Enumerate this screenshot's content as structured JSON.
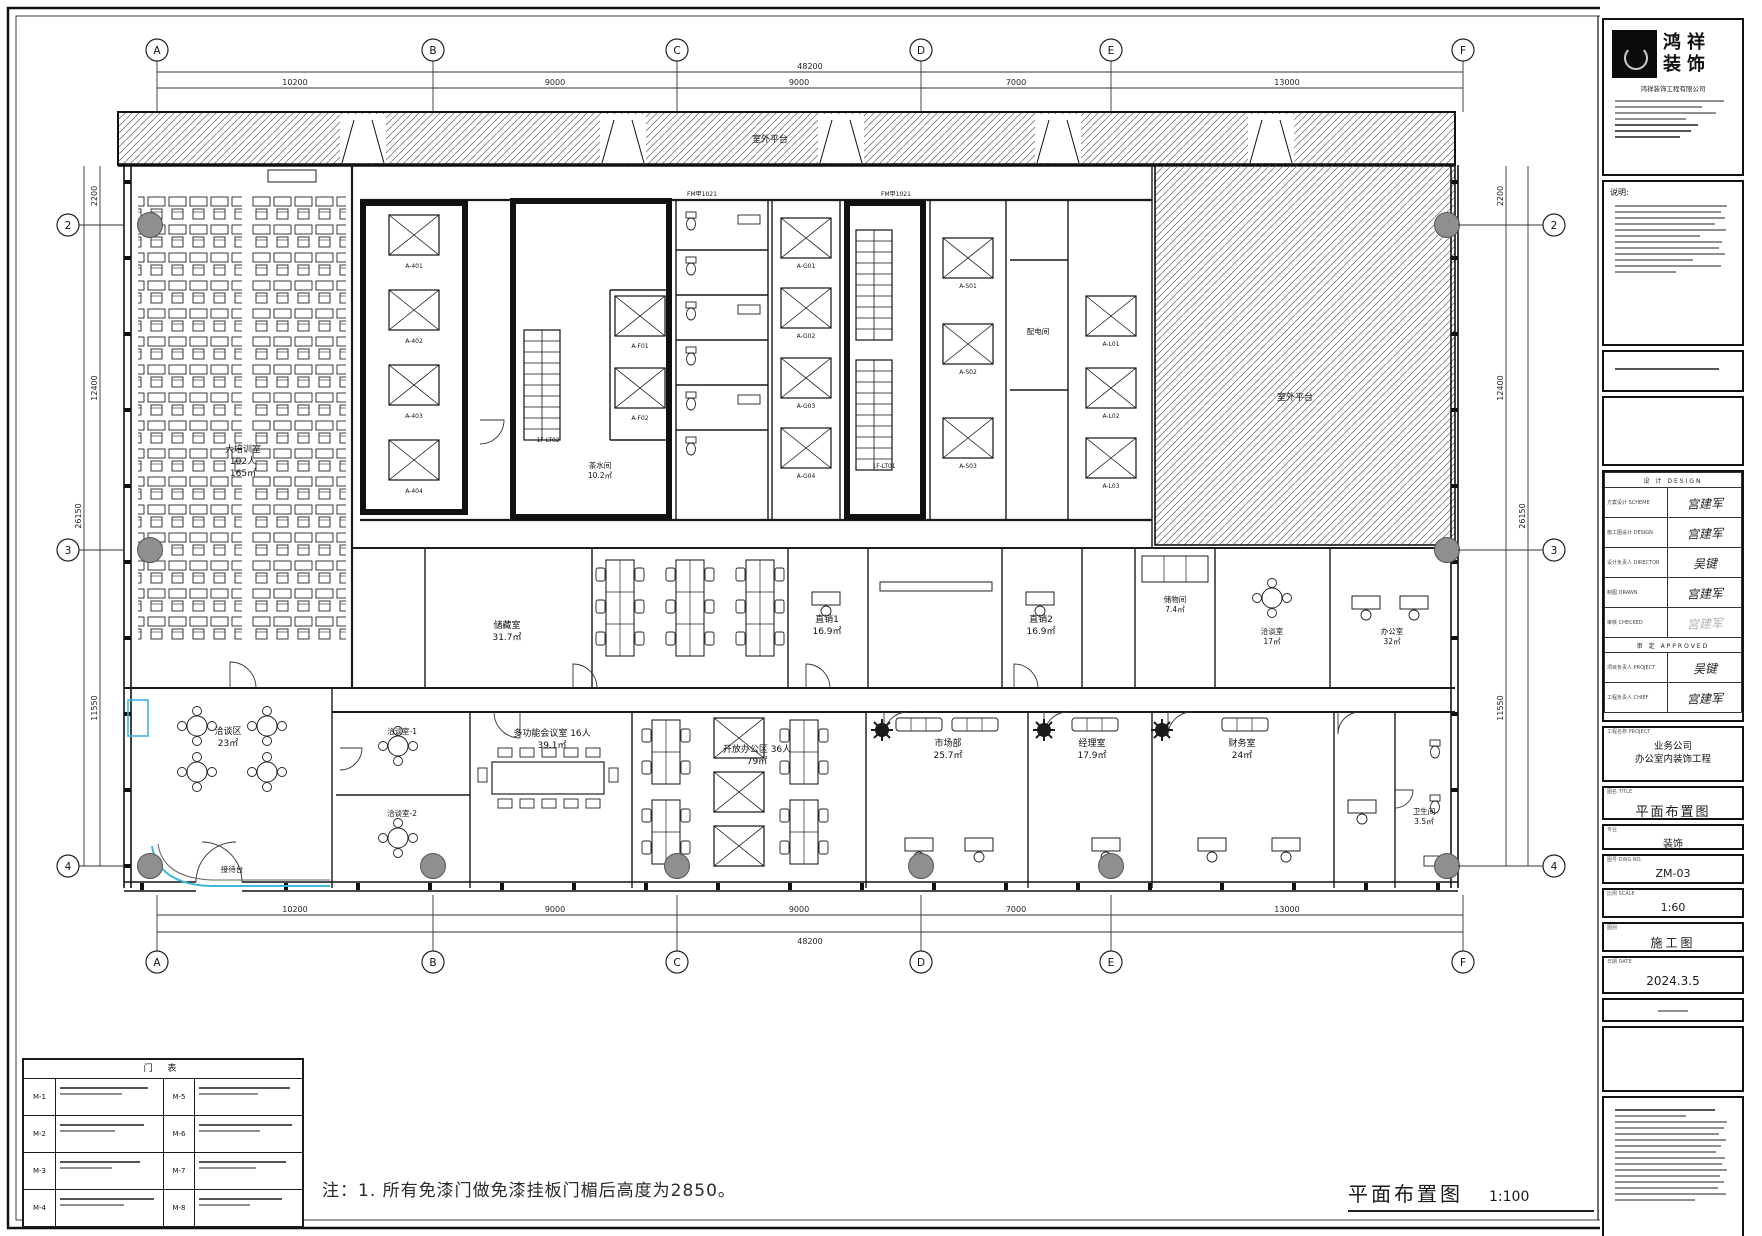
{
  "sheet": {
    "note": "注：1. 所有免漆门做免漆挂板门楣后高度为2850。",
    "title": "平面布置图",
    "scale_label": "1:100"
  },
  "grid": {
    "cols": [
      "A",
      "B",
      "C",
      "D",
      "E",
      "F"
    ],
    "rows": [
      "2",
      "3",
      "4"
    ]
  },
  "dims": {
    "overall_w": "48200",
    "top": [
      "10200",
      "9000",
      "9000",
      "7000",
      "13000"
    ],
    "overall_h": "26150",
    "side": [
      "2200",
      "12400",
      "11550"
    ]
  },
  "plan": {
    "terrace": "室外平台",
    "roof": "室外平台",
    "training_1": "大培训室",
    "training_2": "102人",
    "training_3": "165㎡",
    "storage": "储藏室",
    "storage_a": "31.7㎡",
    "tea": "茶水间",
    "tea_a": "10.2㎡",
    "power": "配电间",
    "zx1": "直销1",
    "zx1_a": "16.9㎡",
    "zx2": "直销2",
    "zx2_a": "16.9㎡",
    "openoffice": "开放办公区 36人",
    "openoffice_a": "79㎡",
    "lounge": "洽谈区",
    "lounge_a": "23㎡",
    "reception": "接待台",
    "meet1": "洽谈室-1",
    "meet2": "洽谈室-2",
    "mfunc": "多功能会议室 16人",
    "mfunc_a": "39.1㎡",
    "market": "市场部",
    "market_a": "25.7㎡",
    "manager": "经理室",
    "manager_a": "17.9㎡",
    "finance": "财务室",
    "finance_a": "24㎡",
    "wc": "卫生间",
    "wc_a": "3.5㎡",
    "storeroom": "储物间",
    "storeroom_a": "7.4㎡",
    "talk17": "洽谈室",
    "talk17_a": "17㎡",
    "office32": "办公室",
    "office32_a": "32㎡",
    "lt01": "1F-LT01",
    "lt02": "1F-LT02",
    "fm1": "FM甲1021",
    "fm2": "FM甲1021",
    "cellsA": [
      "A-401",
      "A-402",
      "A-403",
      "A-404"
    ],
    "cellsF": [
      "A-F01",
      "A-F02"
    ],
    "cellsG": [
      "A-G01",
      "A-G02",
      "A-G03",
      "A-G04"
    ],
    "cellsS": [
      "A-S01",
      "A-S02",
      "A-S03"
    ],
    "cellsL": [
      "A-L01",
      "A-L02",
      "A-L03"
    ]
  },
  "schedule": {
    "title": "门 表",
    "codes": [
      "M-1",
      "M-2",
      "M-3",
      "M-4",
      "M-5",
      "M-6",
      "M-7",
      "M-8"
    ]
  },
  "titleblock": {
    "brand1": "鸿祥",
    "brand2": "装饰",
    "company": "鸿祥装饰工程有限公司",
    "notes_h": "说明:",
    "sig_h1": "设 计 DESIGN",
    "sig_h2": "审 定 APPROVED",
    "sig": [
      {
        "l": "方案设计 SCHEME",
        "v": "宫建军"
      },
      {
        "l": "施工图设计 DESIGN",
        "v": "宫建军"
      },
      {
        "l": "设计负责人 DIRECTOR",
        "v": "吴键"
      },
      {
        "l": "制图 DRAWN",
        "v": "宫建军"
      },
      {
        "l": "审核 CHECKED",
        "v": "宫建军"
      },
      {
        "l": "项目负责人 PROJECT",
        "v": "吴键"
      },
      {
        "l": "工程负责人 CHIEF",
        "v": "宫建军"
      }
    ],
    "pn_label": "工程名称 PROJECT",
    "project1": "业务公司",
    "project2": "办公室内装饰工程",
    "f_title_l": "图名 TITLE",
    "f_title_v": "平面布置图",
    "f_major_l": "专业",
    "f_major_v": "装饰",
    "f_no_l": "图号 DWG NO.",
    "f_no_v": "ZM-03",
    "f_scale_l": "比例 SCALE",
    "f_scale_v": "1:60",
    "f_cat_l": "图别",
    "f_cat_v": "施工图",
    "f_date_l": "日期 DATE",
    "f_date_v": "2024.3.5"
  }
}
